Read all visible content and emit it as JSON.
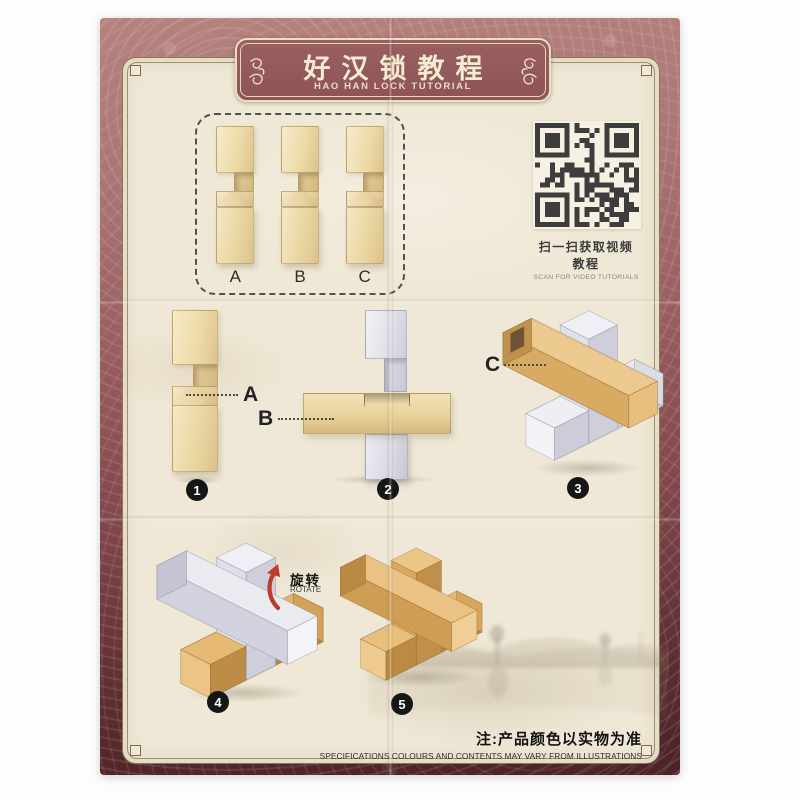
{
  "banner": {
    "title_cn": "好汉锁教程",
    "title_en": "HAO HAN LOCK TUTORIAL"
  },
  "qr": {
    "caption_cn": "扫一扫获取视频教程",
    "caption_en": "SCAN FOR VIDEO TUTORIALS"
  },
  "parts_box": {
    "part_labels": [
      "A",
      "B",
      "C"
    ]
  },
  "steps": {
    "step1": {
      "num": "1",
      "callout": "A"
    },
    "step2": {
      "num": "2",
      "callout": "B"
    },
    "step3": {
      "num": "3",
      "callout": "C"
    },
    "step4": {
      "num": "4",
      "rotate_cn": "旋转",
      "rotate_en": "ROTATE"
    },
    "step5": {
      "num": "5"
    }
  },
  "footer": {
    "note_cn": "注:产品颜色以实物为准",
    "note_en": "SPECIFICATIONS COLOURS AND CONTENTS MAY VARY FROM ILLUSTRATIONS"
  },
  "colors": {
    "border_rose": "#b5827f",
    "border_maroon": "#4b2226",
    "banner_bg": "#945759",
    "paper_cream": "#efe8d6",
    "tan_piece": "#e9d5a4",
    "gold_piece": "#cf9f55",
    "white_piece": "#dfdfe8",
    "badge_black": "#161616",
    "rotate_red": "#bf3a28"
  }
}
